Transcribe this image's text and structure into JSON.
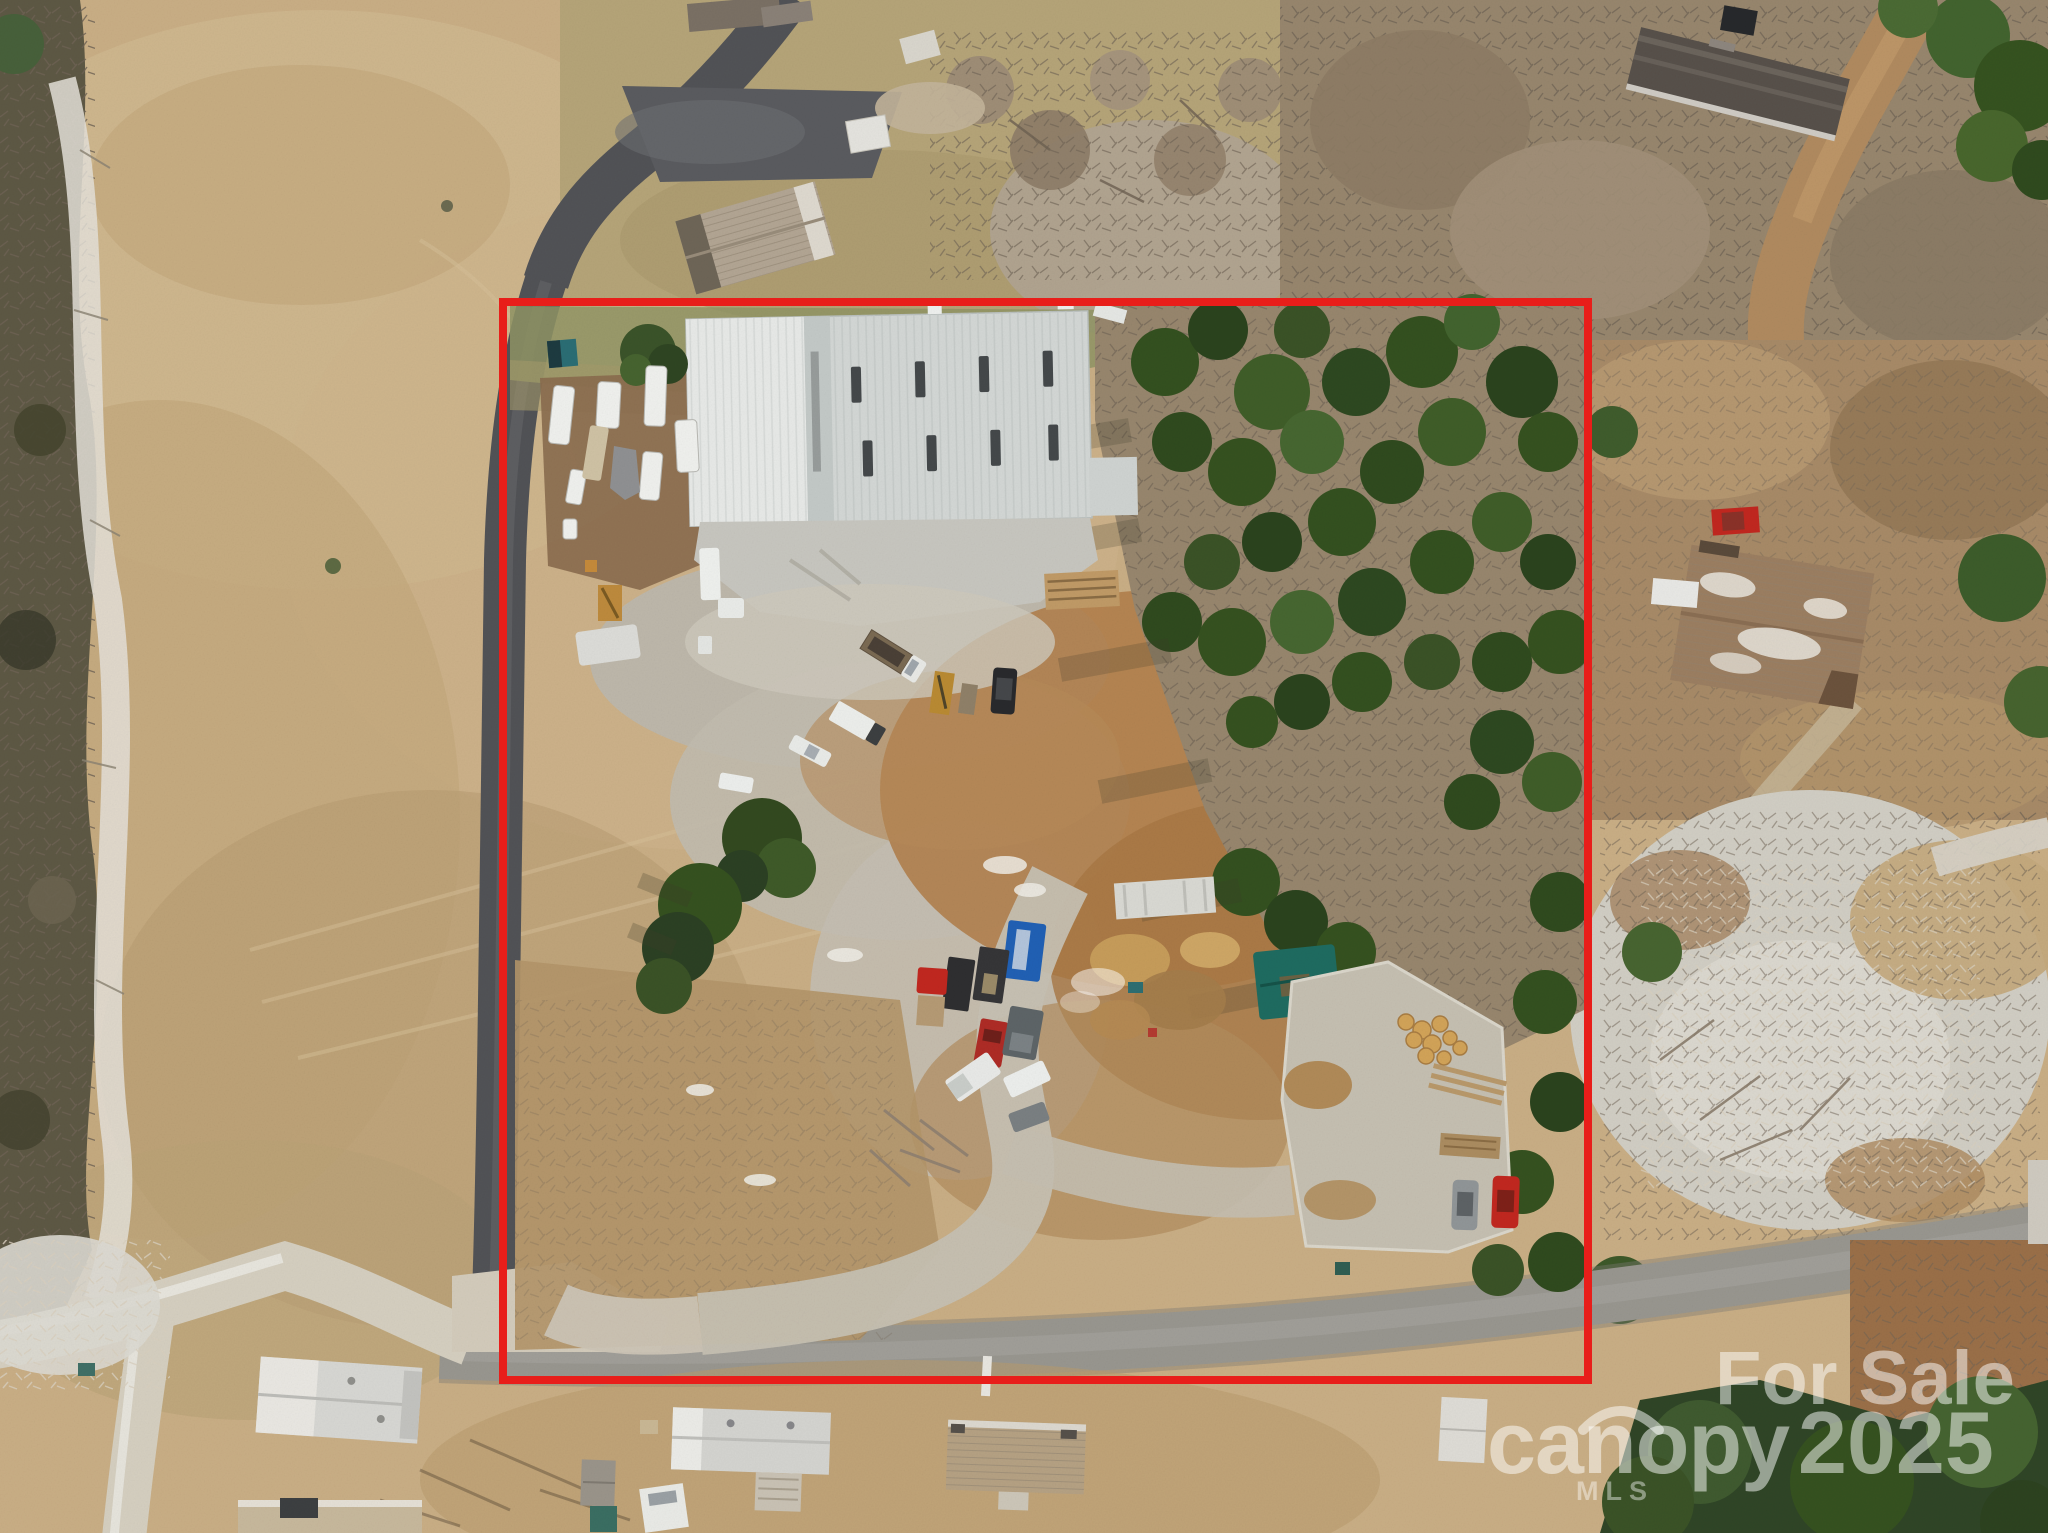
{
  "photo": {
    "kind": "aerial-drone-real-estate-photo",
    "subject": "Commercial property with white metal warehouse, RV and truck yard, wooded acreage, outlined parcel"
  },
  "watermark": {
    "for_sale": "For Sale",
    "brand": "canopy",
    "brand_sub": "MLS",
    "year": "2025",
    "color": "#ffffff"
  },
  "boundary": {
    "color": "#e81e1a",
    "stroke_width": 8,
    "x": 503,
    "y": 302,
    "width": 1085,
    "height": 1078
  },
  "colors": {
    "field": "#c9ae85",
    "field_light": "#d5c09a",
    "field_dark": "#b59a70",
    "left_woods": "#5d5844",
    "bare_woods": "#97866d",
    "forest_green": "#35511f",
    "asphalt_drive": "#515256",
    "road": "#98968f",
    "gravel": "#d5cfc0",
    "yard_gravel": "#bdb7aa",
    "dirt_orange": "#b07c48",
    "warehouse_roof": "#d3d7d5",
    "warehouse_roof_left": "#e7e9e7",
    "concrete": "#c7c6bf",
    "scrub_light": "#d1cec4",
    "tarp_teal": "#1e6b60",
    "dumpster_blue": "#2060b4",
    "red_vehicle": "#c1271f"
  }
}
